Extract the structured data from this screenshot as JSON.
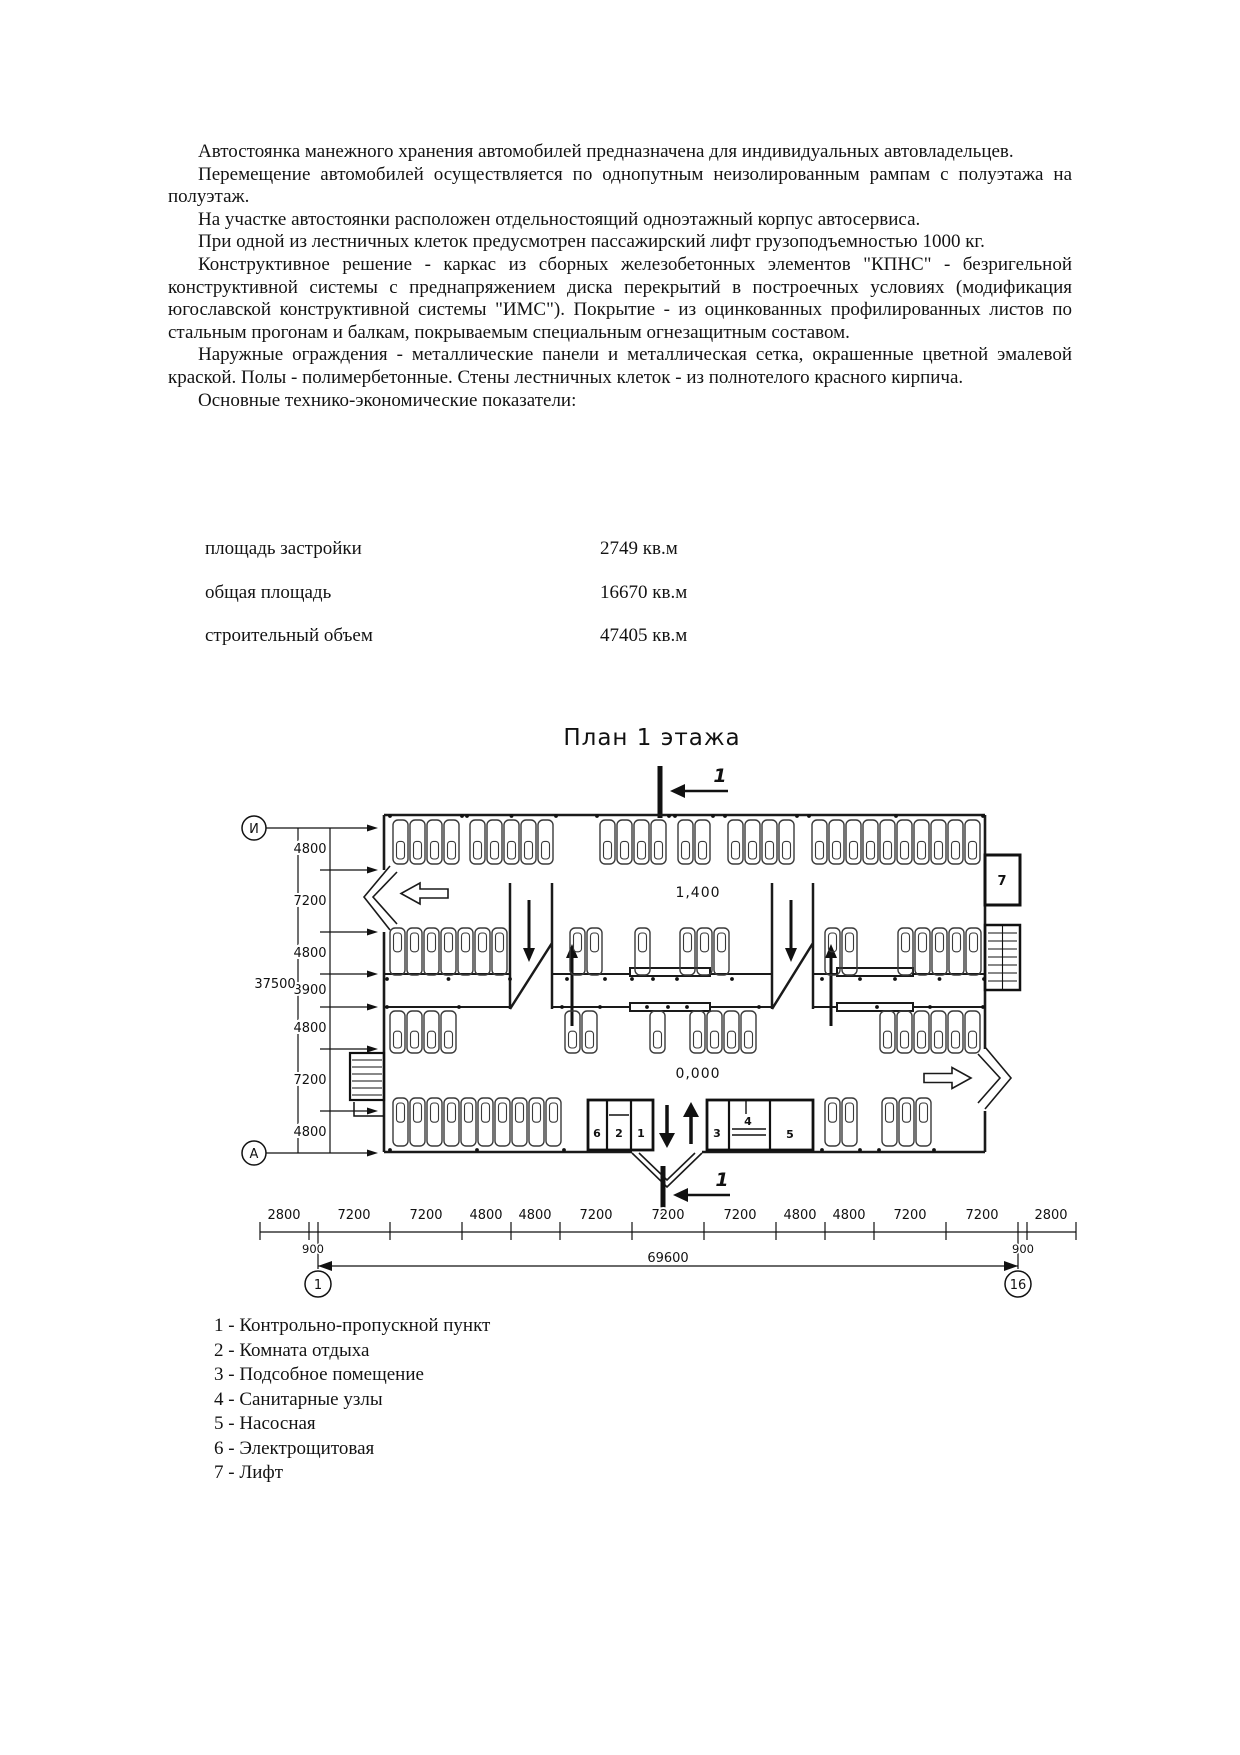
{
  "document": {
    "paragraphs": [
      "Автостоянка манежного хранения автомобилей предназначена для индивидуальных автовладельцев.",
      "Перемещение автомобилей осуществляется по однопутным неизолированным рампам с полуэтажа на полуэтаж.",
      "На участке автостоянки расположен отдельностоящий одноэтажный корпус автосервиса.",
      "При одной из лестничных клеток предусмотрен пассажирский лифт грузоподъемностью 1000 кг.",
      "Конструктивное решение - каркас из сборных железобетонных элементов \"КПНС\" - безригельной конструктивной системы с преднапряжением диска перекрытий в построечных условиях (модификация югославской конструктивной системы \"ИМС\"). Покрытие - из оцинкованных профилированных листов по стальным прогонам и балкам, покрываемым специальным огнезащитным составом.",
      "Наружные ограждения - металлические панели и металлическая сетка, окрашенные цветной эмалевой краской. Полы - полимербетонные. Стены лестничных клеток - из полнотелого красного кирпича."
    ],
    "indicators_intro": "Основные технико-экономические показатели:",
    "indicators": [
      {
        "label": "площадь застройки",
        "value": "2749 кв.м"
      },
      {
        "label": "общая площадь",
        "value": "16670 кв.м"
      },
      {
        "label": "строительный объем",
        "value": "47405 кв.м"
      }
    ]
  },
  "plan": {
    "title": "План 1 этажа",
    "section_label": "1",
    "level_upper": "1,400",
    "level_ground": "0,000",
    "axis_top": "И",
    "axis_bottom": "А",
    "axis_first": "1",
    "axis_last": "16",
    "left_dims": [
      "4800",
      "7200",
      "4800",
      "3900",
      "4800",
      "7200",
      "4800"
    ],
    "left_total": "37500",
    "bottom_dims": [
      "2800",
      "7200",
      "7200",
      "4800",
      "4800",
      "7200",
      "7200",
      "7200",
      "4800",
      "4800",
      "7200",
      "7200",
      "2800"
    ],
    "sub_dims": [
      "900",
      "900"
    ],
    "bottom_total": "69600",
    "rooms": {
      "r1": "1",
      "r2": "2",
      "r3": "3",
      "r4": "4",
      "r5": "5",
      "r6": "6",
      "r7": "7"
    }
  },
  "legend": {
    "items": [
      "1 - Контрольно-пропускной пункт",
      "2 - Комната отдыха",
      "3 - Подсобное помещение",
      "4 - Санитарные узлы",
      "5 - Насосная",
      "6 - Электрощитовая",
      "7 - Лифт"
    ]
  }
}
